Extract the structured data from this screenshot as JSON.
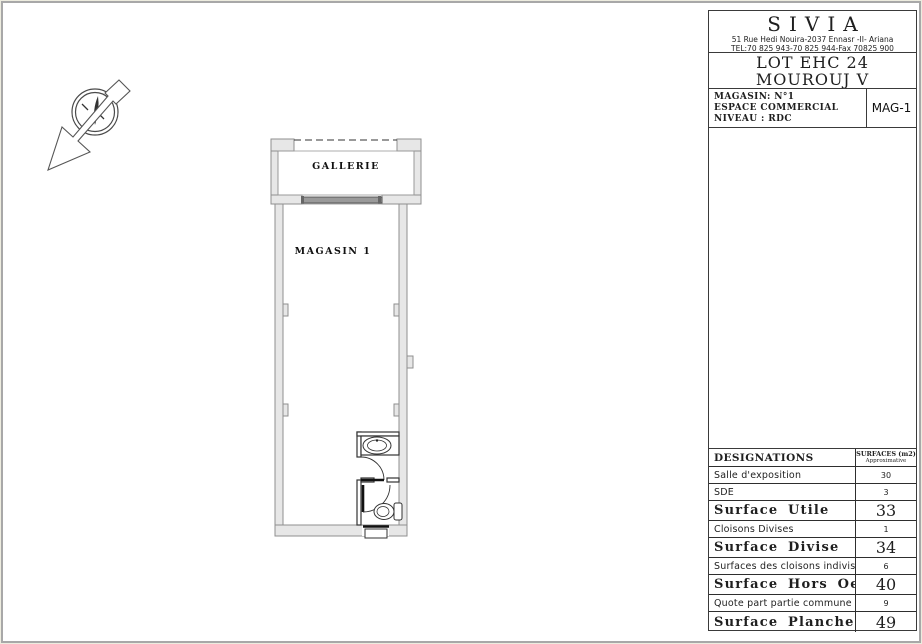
{
  "title_block": {
    "company": {
      "name": "SIVIA",
      "address": "51 Rue Hedi Nouira-2037 Ennasr -II- Ariana",
      "phone": "TEL:70 825 943-70 825 944-Fax 70825 900"
    },
    "project": {
      "line1": "LOT EHC 24",
      "line2": "MOUROUJ V"
    },
    "unit": {
      "line1": "MAGASIN: N°1",
      "line2": "ESPACE COMMERCIAL",
      "line3": "NIVEAU   : RDC",
      "code": "MAG-1"
    }
  },
  "plan": {
    "room_top_label": "GALLERIE",
    "room_main_label": "MAGASIN  1"
  },
  "table": {
    "header": {
      "col1": "DESIGNATIONS",
      "col2_line1": "SURFACES (m2)",
      "col2_line2": "Approximative"
    },
    "rows": [
      {
        "label": "Salle d'exposition",
        "value": "30",
        "emphasis": false
      },
      {
        "label": "SDE",
        "value": "3",
        "emphasis": false
      },
      {
        "label": "Surface Utile",
        "value": "33",
        "emphasis": true
      },
      {
        "label": "Cloisons Divises",
        "value": "1",
        "emphasis": false
      },
      {
        "label": "Surface Divise",
        "value": "34",
        "emphasis": true
      },
      {
        "label": "Surfaces des cloisons indivises",
        "value": "6",
        "emphasis": false
      },
      {
        "label": "Surface Hors Oeuvre",
        "value": "40",
        "emphasis": true
      },
      {
        "label": "Quote part partie commune",
        "value": "9",
        "emphasis": false
      },
      {
        "label": "Surface Plancher",
        "value": "49",
        "emphasis": true
      }
    ]
  },
  "site_plan": {
    "top_parking_stalls": 6,
    "bottom_parking_stalls": 13
  },
  "colors": {
    "sheet_border": "#a8a8a8",
    "wall_fill": "#e7e7e7",
    "wall_stroke": "#8f8f8f",
    "ink": "#1f1f1f",
    "storefront": "#8d8d8d"
  }
}
